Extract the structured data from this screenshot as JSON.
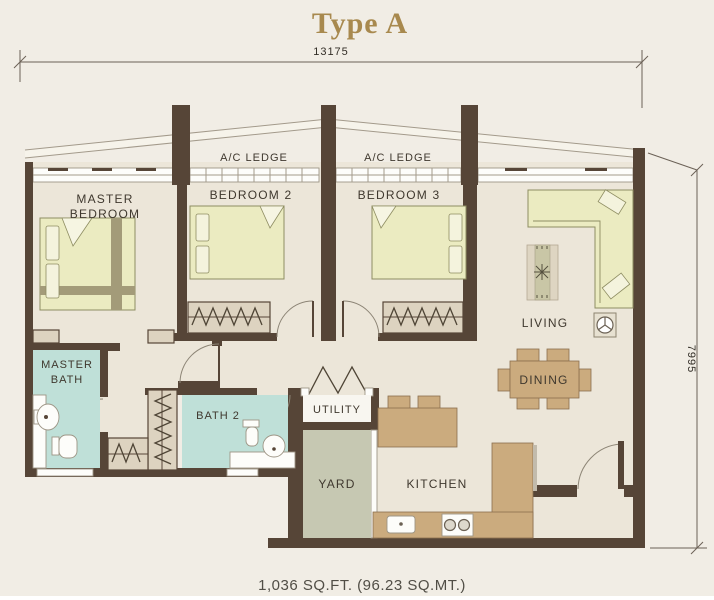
{
  "title": "Type A",
  "dimensions": {
    "width": "13175",
    "height": "7995"
  },
  "area": "1,036 SQ.FT. (96.23 SQ.MT.)",
  "rooms": {
    "master_bedroom_line1": "MASTER",
    "master_bedroom_line2": "BEDROOM",
    "bedroom2": "BEDROOM 2",
    "bedroom3": "BEDROOM 3",
    "ac_ledge_left": "A/C LEDGE",
    "ac_ledge_right": "A/C LEDGE",
    "living": "LIVING",
    "dining": "DINING",
    "master_bath_line1": "MASTER",
    "master_bath_line2": "BATH",
    "bath2": "BATH 2",
    "utility": "UTILITY",
    "yard": "YARD",
    "kitchen": "KITCHEN"
  },
  "colors": {
    "wall": "#564537",
    "background": "#f1ede5",
    "floor": "#ece6d9",
    "bath_floor": "#bfe0d8",
    "bed_fill": "#ebebc1",
    "furniture_tan": "#cbab7e",
    "yard_floor": "#c6c8b2",
    "title_gold": "#a8894e"
  }
}
